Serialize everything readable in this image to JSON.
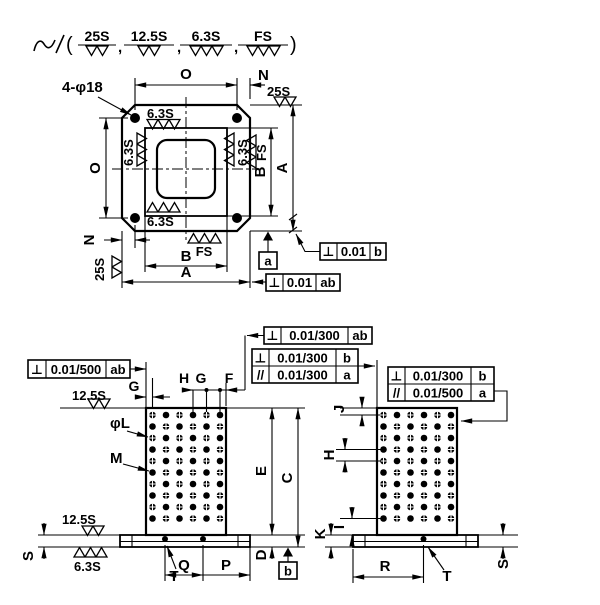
{
  "colors": {
    "part_fill": "#d9edf7",
    "line": "#000000"
  },
  "legend": {
    "open_paren": "(",
    "close_paren": ")",
    "comma": ",",
    "items": [
      {
        "label": "25S"
      },
      {
        "label": "12.5S"
      },
      {
        "label": "6.3S"
      },
      {
        "label": "FS"
      }
    ]
  },
  "top_view": {
    "hole_callout": "4-φ18",
    "dim_o_top": "O",
    "dim_n_top": "N",
    "dim_o_left": "O",
    "dim_b_right": "B",
    "dim_a_right": "A",
    "dim_n_bottom": "N",
    "dim_b_bottom": "B",
    "dim_a_bottom": "A",
    "finish_top_right": "25S",
    "finish_inner_top": "6.3S",
    "finish_inner_left": "6.3S",
    "finish_inner_right": "6.3S",
    "finish_outer_right": "FS",
    "finish_inner_bottom": "6.3S",
    "finish_outer_bottom": "FS",
    "finish_bottom_left": "25S",
    "datum_a": "a",
    "tol_perp_b": {
      "sym": "⊥",
      "val": "0.01",
      "ref": "b"
    },
    "tol_perp_ab": {
      "sym": "⊥",
      "val": "0.01",
      "ref": "ab"
    }
  },
  "front_view": {
    "tol_left": {
      "sym": "⊥",
      "val": "0.01/500",
      "ref": "ab"
    },
    "tol_top": {
      "sym": "⊥",
      "val": "0.01/300",
      "ref": "ab"
    },
    "tol_mid": {
      "row1": {
        "sym": "⊥",
        "val": "0.01/300",
        "ref": "b"
      },
      "row2": {
        "sym": "//",
        "val": "0.01/300",
        "ref": "a"
      }
    },
    "finish_top": "12.5S",
    "dim_g_left": "G",
    "dim_h": "H",
    "dim_g": "G",
    "dim_f": "F",
    "hole_dia_label": "φL",
    "hole_label_m": "M",
    "dim_e": "E",
    "dim_c": "C",
    "dim_d": "D",
    "dim_s": "S",
    "dim_q": "Q",
    "dim_p": "P",
    "label_t": "T",
    "finish_base_top": "12.5S",
    "finish_base_bottom": "6.3S",
    "datum_b": "b"
  },
  "right_view": {
    "tol": {
      "row1": {
        "sym": "⊥",
        "val": "0.01/300",
        "ref": "b"
      },
      "row2": {
        "sym": "//",
        "val": "0.01/500",
        "ref": "a"
      }
    },
    "dim_j": "J",
    "dim_h": "H",
    "dim_i": "I",
    "dim_k": "K",
    "dim_r": "R",
    "dim_s": "S",
    "label_t": "T"
  },
  "grid": {
    "cols": 6,
    "rows": 10,
    "col_pitch": 13.5,
    "row_pitch": 11.5,
    "hole_r": 3.3
  }
}
